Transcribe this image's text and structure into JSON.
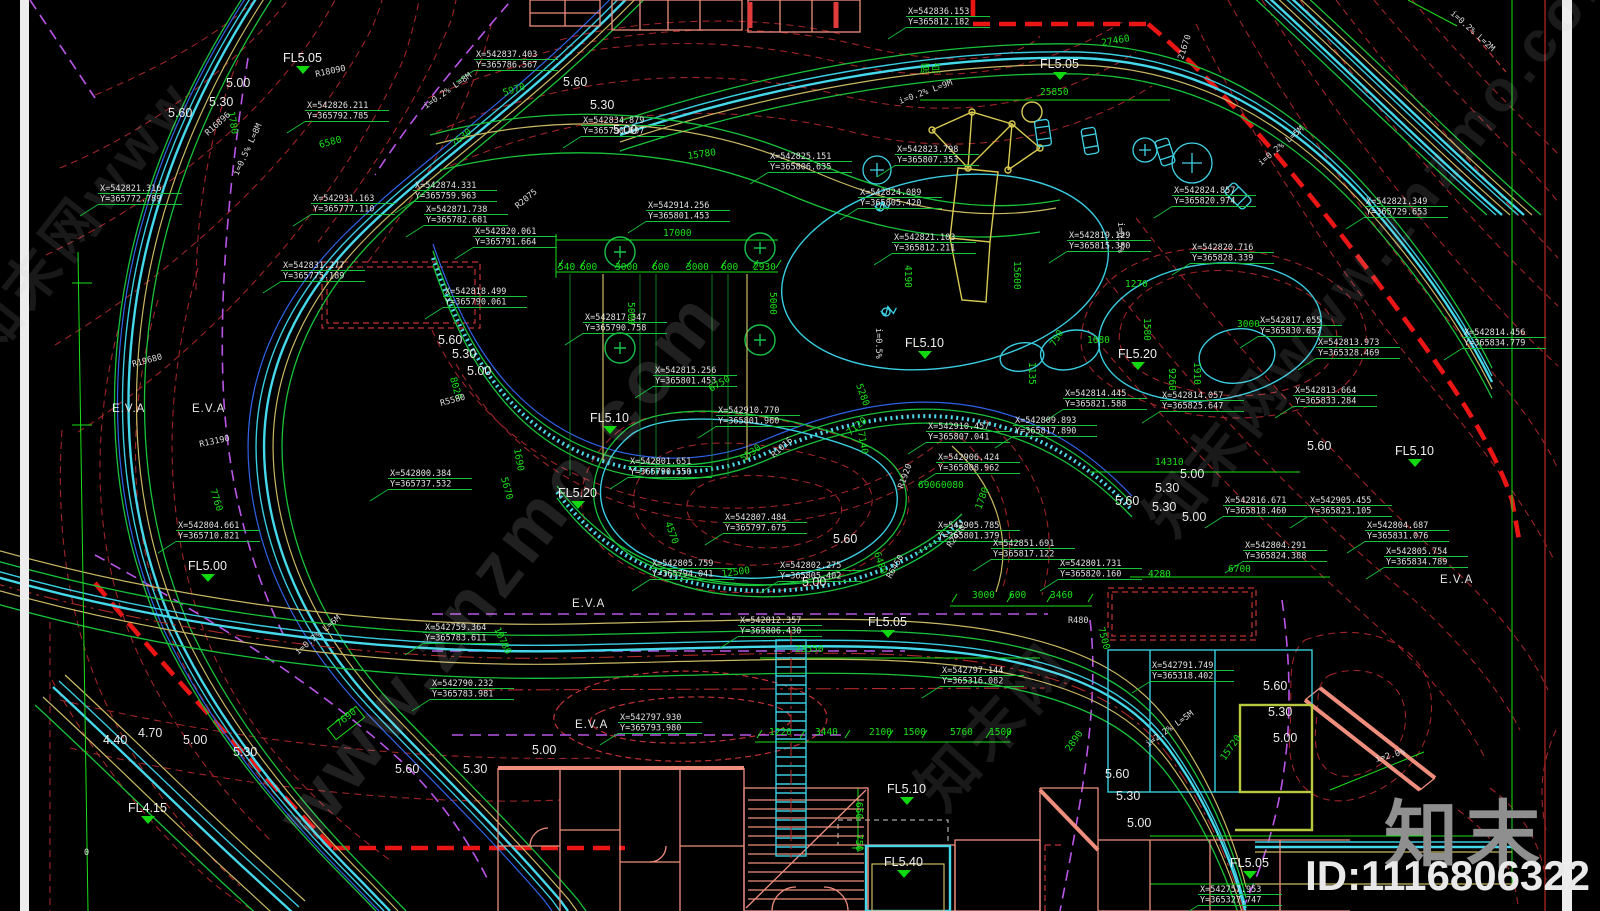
{
  "meta": {
    "brand": "知末",
    "id_label": "ID:1116806322",
    "origin_label": "原点",
    "zero_label": "0",
    "colors": {
      "cad_green": "#1ae11a",
      "contour_red": "#9e2428",
      "boundary_red": "#ea1515",
      "road_cyan": "#38cde0",
      "road_yellow": "#c9b964",
      "purple_dashed": "#bb55e8",
      "building_pink": "#ef8e7d",
      "text_white": "#e2e2e2"
    }
  },
  "watermarks": [
    {
      "text": "www.znzmo.com",
      "x": 520,
      "y": 580,
      "rot": -52,
      "size": 74,
      "opacity": 0.16
    },
    {
      "text": "知末网www.znzmo.com",
      "x": 1400,
      "y": 250,
      "rot": -52,
      "size": 58,
      "opacity": 0.13
    },
    {
      "text": "知末网",
      "x": 1010,
      "y": 740,
      "rot": -48,
      "size": 60,
      "opacity": 0.12
    },
    {
      "text": "知末网www",
      "x": 95,
      "y": 230,
      "rot": -52,
      "size": 56,
      "opacity": 0.12
    }
  ],
  "fl_markers": [
    {
      "t": "FL5.05",
      "x": 283,
      "y": 62
    },
    {
      "t": "FL5.05",
      "x": 1040,
      "y": 68
    },
    {
      "t": "FL5.10",
      "x": 905,
      "y": 347
    },
    {
      "t": "FL5.10",
      "x": 590,
      "y": 422
    },
    {
      "t": "FL5.20",
      "x": 558,
      "y": 497
    },
    {
      "t": "FL5.20",
      "x": 1118,
      "y": 358
    },
    {
      "t": "FL5.00",
      "x": 188,
      "y": 570
    },
    {
      "t": "FL4.15",
      "x": 128,
      "y": 812
    },
    {
      "t": "FL5.05",
      "x": 868,
      "y": 626
    },
    {
      "t": "FL5.10",
      "x": 887,
      "y": 793
    },
    {
      "t": "FL5.40",
      "x": 884,
      "y": 866
    },
    {
      "t": "FL5.05",
      "x": 1230,
      "y": 867
    },
    {
      "t": "FL5.10",
      "x": 1395,
      "y": 455
    }
  ],
  "elevations": [
    {
      "t": "5.60",
      "x": 168,
      "y": 117
    },
    {
      "t": "5.30",
      "x": 209,
      "y": 106
    },
    {
      "t": "5.00",
      "x": 226,
      "y": 87
    },
    {
      "t": "5.60",
      "x": 563,
      "y": 86
    },
    {
      "t": "5.30",
      "x": 590,
      "y": 109
    },
    {
      "t": "5.00",
      "x": 613,
      "y": 134
    },
    {
      "t": "5.60",
      "x": 438,
      "y": 344
    },
    {
      "t": "5.30",
      "x": 452,
      "y": 358
    },
    {
      "t": "5.00",
      "x": 467,
      "y": 375
    },
    {
      "t": "5.60",
      "x": 833,
      "y": 543
    },
    {
      "t": "5.00",
      "x": 802,
      "y": 586
    },
    {
      "t": "5.60",
      "x": 1307,
      "y": 450
    },
    {
      "t": "5.00",
      "x": 1180,
      "y": 478
    },
    {
      "t": "5.30",
      "x": 1155,
      "y": 492
    },
    {
      "t": "5.60",
      "x": 1115,
      "y": 505
    },
    {
      "t": "5.30",
      "x": 1152,
      "y": 511
    },
    {
      "t": "5.00",
      "x": 1182,
      "y": 521
    },
    {
      "t": "5.60",
      "x": 1263,
      "y": 690
    },
    {
      "t": "5.30",
      "x": 1268,
      "y": 716
    },
    {
      "t": "5.00",
      "x": 1273,
      "y": 742
    },
    {
      "t": "5.60",
      "x": 1105,
      "y": 778
    },
    {
      "t": "5.30",
      "x": 1116,
      "y": 800
    },
    {
      "t": "5.00",
      "x": 1127,
      "y": 827
    },
    {
      "t": "4.40",
      "x": 103,
      "y": 744
    },
    {
      "t": "4.70",
      "x": 138,
      "y": 737
    },
    {
      "t": "5.00",
      "x": 183,
      "y": 744
    },
    {
      "t": "5.30",
      "x": 233,
      "y": 756
    },
    {
      "t": "5.60",
      "x": 395,
      "y": 773
    },
    {
      "t": "5.30",
      "x": 463,
      "y": 773
    },
    {
      "t": "5.00",
      "x": 532,
      "y": 754
    }
  ],
  "eva_labels": [
    {
      "t": "E.V.A",
      "x": 112,
      "y": 412
    },
    {
      "t": "E.V.A",
      "x": 192,
      "y": 412
    },
    {
      "t": "E.V.A",
      "x": 572,
      "y": 607
    },
    {
      "t": "E.V.A",
      "x": 575,
      "y": 728
    },
    {
      "t": "E.V.A",
      "x": 1440,
      "y": 583
    }
  ],
  "coords": [
    {
      "x": 100,
      "y": 183,
      "a": "X=542821.316",
      "b": "Y=365772.789"
    },
    {
      "x": 307,
      "y": 100,
      "a": "X=542826.211",
      "b": "Y=365792.785"
    },
    {
      "x": 415,
      "y": 180,
      "a": "X=542874.331",
      "b": "Y=365759.963"
    },
    {
      "x": 426,
      "y": 204,
      "a": "X=542871.738",
      "b": "Y=365782.681"
    },
    {
      "x": 475,
      "y": 226,
      "a": "X=542820.061",
      "b": "Y=365791.664"
    },
    {
      "x": 283,
      "y": 260,
      "a": "X=542831.277",
      "b": "Y=365775.189"
    },
    {
      "x": 313,
      "y": 193,
      "a": "X=542931.163",
      "b": "Y=365777.110"
    },
    {
      "x": 476,
      "y": 49,
      "a": "X=542837.403",
      "b": "Y=365786.567"
    },
    {
      "x": 583,
      "y": 115,
      "a": "X=542834.879",
      "b": "Y=365790.897"
    },
    {
      "x": 770,
      "y": 151,
      "a": "X=542825.151",
      "b": "Y=365806.635"
    },
    {
      "x": 648,
      "y": 200,
      "a": "X=542914.256",
      "b": "Y=365801.453"
    },
    {
      "x": 445,
      "y": 286,
      "a": "X=542818.499",
      "b": "Y=365790.061"
    },
    {
      "x": 585,
      "y": 312,
      "a": "X=542817.347",
      "b": "Y=365790.758"
    },
    {
      "x": 655,
      "y": 365,
      "a": "X=542815.256",
      "b": "Y=365801.453"
    },
    {
      "x": 718,
      "y": 405,
      "a": "X=542910.770",
      "b": "Y=365801.960"
    },
    {
      "x": 630,
      "y": 456,
      "a": "X=542801.651",
      "b": "Y=365790.550"
    },
    {
      "x": 725,
      "y": 512,
      "a": "X=542807.484",
      "b": "Y=365797.675"
    },
    {
      "x": 652,
      "y": 558,
      "a": "X=542805.759",
      "b": "Y=365794.041"
    },
    {
      "x": 780,
      "y": 560,
      "a": "X=542802.275",
      "b": "Y=365805.402"
    },
    {
      "x": 928,
      "y": 421,
      "a": "X=542910.457",
      "b": "Y=365807.041"
    },
    {
      "x": 938,
      "y": 452,
      "a": "X=542906.424",
      "b": "Y=365808.962"
    },
    {
      "x": 938,
      "y": 520,
      "a": "X=542905.785",
      "b": "Y=365801.379"
    },
    {
      "x": 993,
      "y": 538,
      "a": "X=542851.691",
      "b": "Y=365817.122"
    },
    {
      "x": 1060,
      "y": 558,
      "a": "X=542801.731",
      "b": "Y=365820.160"
    },
    {
      "x": 1245,
      "y": 540,
      "a": "X=542804.291",
      "b": "Y=365824.388"
    },
    {
      "x": 1015,
      "y": 415,
      "a": "X=542809.893",
      "b": "Y=365817.890"
    },
    {
      "x": 1065,
      "y": 388,
      "a": "X=542814.445",
      "b": "Y=365821.588"
    },
    {
      "x": 1162,
      "y": 390,
      "a": "X=542814.057",
      "b": "Y=365825.647"
    },
    {
      "x": 1295,
      "y": 385,
      "a": "X=542813.664",
      "b": "Y=365833.284"
    },
    {
      "x": 1367,
      "y": 520,
      "a": "X=542804.687",
      "b": "Y=365831.076"
    },
    {
      "x": 1386,
      "y": 546,
      "a": "X=542805.754",
      "b": "Y=365834.789"
    },
    {
      "x": 1310,
      "y": 495,
      "a": "X=542905.455",
      "b": "Y=365823.105"
    },
    {
      "x": 1225,
      "y": 495,
      "a": "X=542816.671",
      "b": "Y=365818.460"
    },
    {
      "x": 1366,
      "y": 196,
      "a": "X=542821.349",
      "b": "Y=365729.653"
    },
    {
      "x": 1192,
      "y": 242,
      "a": "X=542820.716",
      "b": "Y=365828.339"
    },
    {
      "x": 1260,
      "y": 315,
      "a": "X=542817.055",
      "b": "Y=365830.657"
    },
    {
      "x": 1318,
      "y": 337,
      "a": "X=542813.973",
      "b": "Y=365328.469"
    },
    {
      "x": 1464,
      "y": 327,
      "a": "X=542814.456",
      "b": "Y=365834.779"
    },
    {
      "x": 897,
      "y": 144,
      "a": "X=542823.798",
      "b": "Y=365807.353"
    },
    {
      "x": 860,
      "y": 187,
      "a": "X=542824.089",
      "b": "Y=365805.420"
    },
    {
      "x": 894,
      "y": 232,
      "a": "X=542821.103",
      "b": "Y=365812.211"
    },
    {
      "x": 1069,
      "y": 230,
      "a": "X=542819.129",
      "b": "Y=365815.380"
    },
    {
      "x": 1174,
      "y": 185,
      "a": "X=542824.857",
      "b": "Y=365820.974"
    },
    {
      "x": 178,
      "y": 520,
      "a": "X=542804.661",
      "b": "Y=365710.821"
    },
    {
      "x": 390,
      "y": 468,
      "a": "X=542800.384",
      "b": "Y=365737.532"
    },
    {
      "x": 425,
      "y": 622,
      "a": "X=542759.364",
      "b": "Y=365783.611"
    },
    {
      "x": 432,
      "y": 678,
      "a": "X=542790.232",
      "b": "Y=365783.981"
    },
    {
      "x": 740,
      "y": 615,
      "a": "X=542812.357",
      "b": "Y=365806.430"
    },
    {
      "x": 620,
      "y": 712,
      "a": "X=542797.930",
      "b": "Y=365793.980"
    },
    {
      "x": 942,
      "y": 665,
      "a": "X=542797.144",
      "b": "Y=365316.082"
    },
    {
      "x": 1152,
      "y": 660,
      "a": "X=542791.749",
      "b": "Y=365318.402"
    },
    {
      "x": 1200,
      "y": 884,
      "a": "X=542757.953",
      "b": "Y=365327.747"
    },
    {
      "x": 908,
      "y": 6,
      "a": "X=542836.153",
      "b": "Y=365812.182"
    }
  ],
  "green_dims": [
    [
      "17000",
      663,
      236,
      0
    ],
    [
      "540",
      558,
      270,
      0
    ],
    [
      "600",
      580,
      270,
      0
    ],
    [
      "3000",
      615,
      270,
      0
    ],
    [
      "600",
      652,
      270,
      0
    ],
    [
      "3000",
      686,
      270,
      0
    ],
    [
      "600",
      721,
      270,
      0
    ],
    [
      "2930",
      753,
      270,
      0
    ],
    [
      "5000",
      628,
      302,
      90
    ],
    [
      "5000",
      770,
      292,
      90
    ],
    [
      "15780",
      688,
      159,
      -8
    ],
    [
      "5970",
      504,
      96,
      -18
    ],
    [
      "7630",
      454,
      147,
      -38
    ],
    [
      "1780",
      228,
      112,
      80
    ],
    [
      "6580",
      320,
      148,
      -15
    ],
    [
      "1690",
      514,
      449,
      80
    ],
    [
      "5670",
      501,
      478,
      75
    ],
    [
      "25850",
      1040,
      95,
      0
    ],
    [
      "27460",
      1102,
      46,
      -10
    ],
    [
      "14310",
      1155,
      465,
      0
    ],
    [
      "6700",
      1228,
      572,
      0
    ],
    [
      "4280",
      1148,
      577,
      0
    ],
    [
      "3000",
      972,
      598,
      0
    ],
    [
      "600",
      1009,
      598,
      0
    ],
    [
      "3460",
      1050,
      598,
      0
    ],
    [
      "23550",
      795,
      652,
      0
    ],
    [
      "1220",
      769,
      735,
      0
    ],
    [
      "3440",
      815,
      735,
      0
    ],
    [
      "2100",
      869,
      735,
      0
    ],
    [
      "1500",
      903,
      735,
      0
    ],
    [
      "5760",
      950,
      735,
      0
    ],
    [
      "1500",
      989,
      735,
      0
    ],
    [
      "650",
      856,
      802,
      90
    ],
    [
      "750",
      856,
      834,
      90
    ],
    [
      "69060080",
      918,
      488,
      0
    ],
    [
      "1780",
      981,
      510,
      -70
    ],
    [
      "6480",
      874,
      553,
      72
    ],
    [
      "12500",
      722,
      577,
      -8
    ],
    [
      "4570",
      665,
      523,
      70
    ],
    [
      "5530",
      743,
      462,
      -35
    ],
    [
      "7120",
      850,
      436,
      -40
    ],
    [
      "6750",
      711,
      392,
      -30
    ],
    [
      "8020",
      450,
      378,
      75
    ],
    [
      "7140",
      858,
      432,
      80
    ],
    [
      "5280",
      856,
      385,
      70
    ],
    [
      "7760",
      210,
      490,
      72
    ],
    [
      "10780",
      494,
      629,
      65
    ],
    [
      "7690",
      339,
      727,
      -38
    ],
    [
      "1270",
      1125,
      287,
      0
    ],
    [
      "1680",
      1087,
      343,
      0
    ],
    [
      "750",
      1055,
      347,
      -60
    ],
    [
      "1135",
      1029,
      362,
      90
    ],
    [
      "1580",
      1144,
      318,
      90
    ],
    [
      "1910",
      1194,
      362,
      90
    ],
    [
      "9260",
      1169,
      368,
      90
    ],
    [
      "3000",
      1237,
      327,
      0
    ],
    [
      "4190",
      905,
      265,
      90
    ],
    [
      "15600",
      1014,
      261,
      90
    ],
    [
      "15720",
      1225,
      761,
      -55
    ],
    [
      "7500",
      1098,
      628,
      75
    ],
    [
      "2890",
      1070,
      752,
      -55
    ]
  ],
  "white_dims": [
    [
      "R18090",
      316,
      77,
      -12
    ],
    [
      "R16896",
      208,
      136,
      -42
    ],
    [
      "i=0.5% L=8M",
      238,
      176,
      -65
    ],
    [
      "i=0.2% L=9M",
      900,
      104,
      -20
    ],
    [
      "i=0.2% L=2M",
      1450,
      14,
      42
    ],
    [
      "i=0.2% L=8M",
      426,
      109,
      -35
    ],
    [
      "R19680",
      133,
      367,
      -15
    ],
    [
      "R13190",
      200,
      447,
      -12
    ],
    [
      "R5580",
      441,
      406,
      -15
    ],
    [
      "R2075",
      518,
      209,
      -40
    ],
    [
      "R1016",
      774,
      458,
      -42
    ],
    [
      "i=0.5%",
      876,
      328,
      90
    ],
    [
      "i=0.5%",
      1118,
      222,
      90
    ],
    [
      "i=2.2% L=5M",
      1148,
      747,
      -35
    ],
    [
      "i=2.0%",
      1376,
      762,
      -15
    ],
    [
      "i=0.2% L=6M",
      298,
      655,
      -40
    ],
    [
      "i=0.2% L=5M",
      1261,
      166,
      -40
    ],
    [
      "21670",
      1183,
      60,
      -72
    ],
    [
      "R1920",
      903,
      489,
      -70
    ],
    [
      "R2410",
      951,
      548,
      -55
    ],
    [
      "R6450",
      891,
      579,
      -60
    ],
    [
      "R480",
      1068,
      623,
      0
    ]
  ],
  "misc_labels": [
    {
      "t": "原点",
      "x": 920,
      "y": 72,
      "cls": "tMiscG"
    },
    {
      "t": "0",
      "x": 84,
      "y": 855,
      "cls": "tCoord"
    }
  ]
}
